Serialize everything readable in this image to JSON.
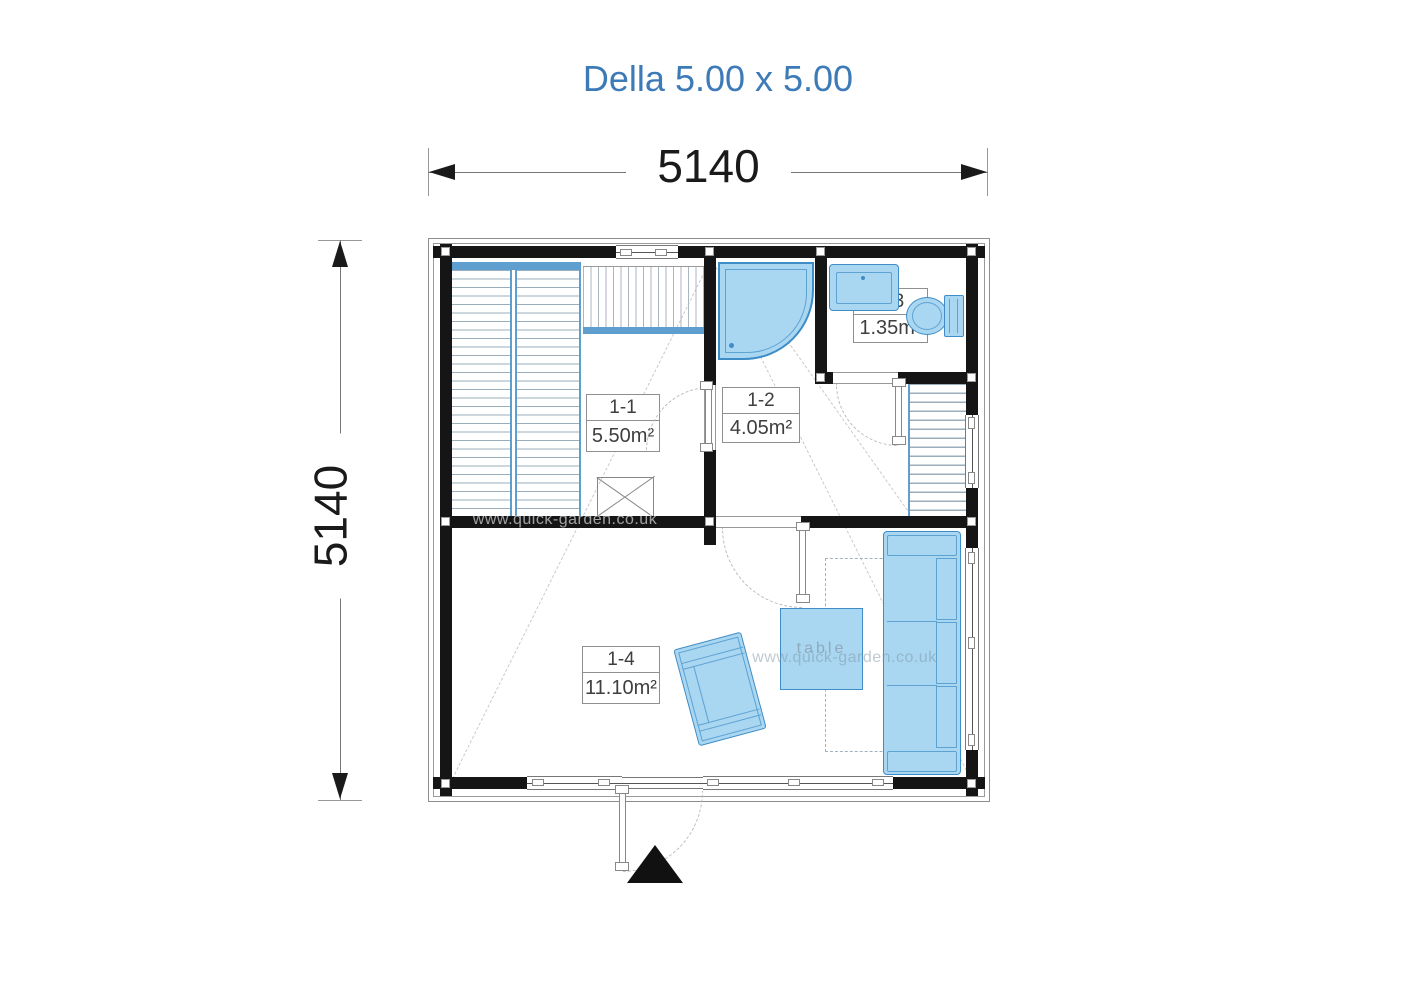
{
  "title": "Della 5.00 x 5.00",
  "dimensions": {
    "horizontal": "5140",
    "vertical": "5140"
  },
  "rooms": [
    {
      "id": "1-1",
      "area": "5.50m²"
    },
    {
      "id": "1-2",
      "area": "4.05m²"
    },
    {
      "id": "1-3",
      "area": "1.35m²"
    },
    {
      "id": "1-4",
      "area": "11.10m²"
    }
  ],
  "table_label": "table",
  "watermark": "www.quick-garden.co.uk",
  "fixtures": [
    "staircase",
    "loft-hatch",
    "chimney",
    "shower",
    "washbasin",
    "toilet",
    "loft-ladder",
    "sofa",
    "armchair",
    "table",
    "entrance-arrow",
    "door-swing",
    "window"
  ],
  "colors": {
    "title": "#3d7ab8",
    "wall": "#151515",
    "furniture_fill": "#a9d6f1",
    "furniture_border": "#3f8dc6",
    "furniture_inner": "#5ea2d2",
    "rail_blue": "#5f9fd0",
    "stripe": "#9aaebb",
    "dash": "#cacaca",
    "label_border": "#8f8f8f",
    "dim": "#1a1a1a"
  }
}
